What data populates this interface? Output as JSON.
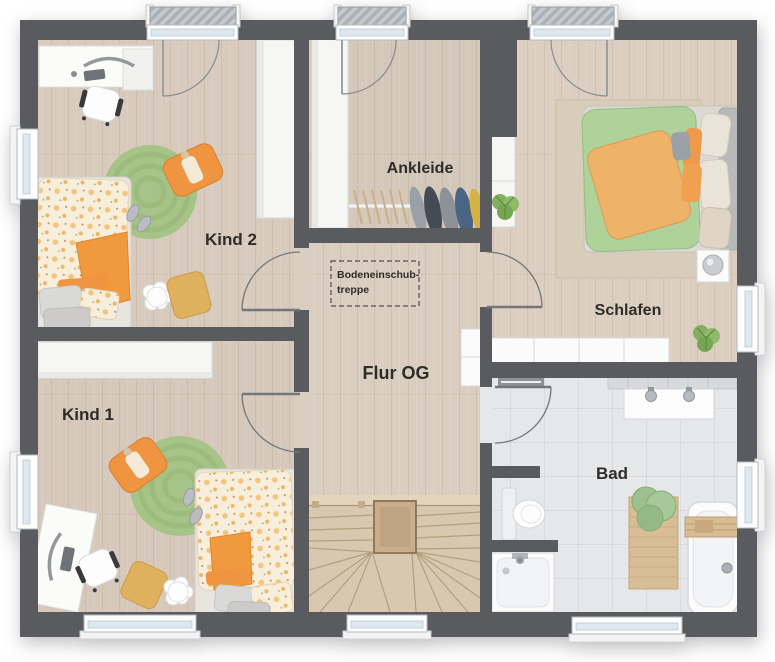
{
  "floorplan": {
    "rooms": {
      "kind2": {
        "label": "Kind 2"
      },
      "kind1": {
        "label": "Kind 1"
      },
      "ankleide": {
        "label": "Ankleide"
      },
      "schlafen": {
        "label": "Schlafen"
      },
      "flur": {
        "label": "Flur OG"
      },
      "bad": {
        "label": "Bad"
      }
    },
    "annotations": {
      "attic_stairs": {
        "line1": "Bodeneinschub-",
        "line2": "treppe"
      }
    },
    "colors": {
      "wall": "#595b5e",
      "wood_floor": "#d8ccbe",
      "tile_floor": "#e6e7e9",
      "stairs_wood": "#d8c8b0",
      "rug_green": "#a6c487",
      "accent_orange": "#ef9440",
      "bed_green": "#aed29a",
      "bed_orange": "#eeb269",
      "furniture_white": "#fbfbfb",
      "plant_green": "#7fae5e",
      "label_text": "#2e2d2a"
    }
  }
}
